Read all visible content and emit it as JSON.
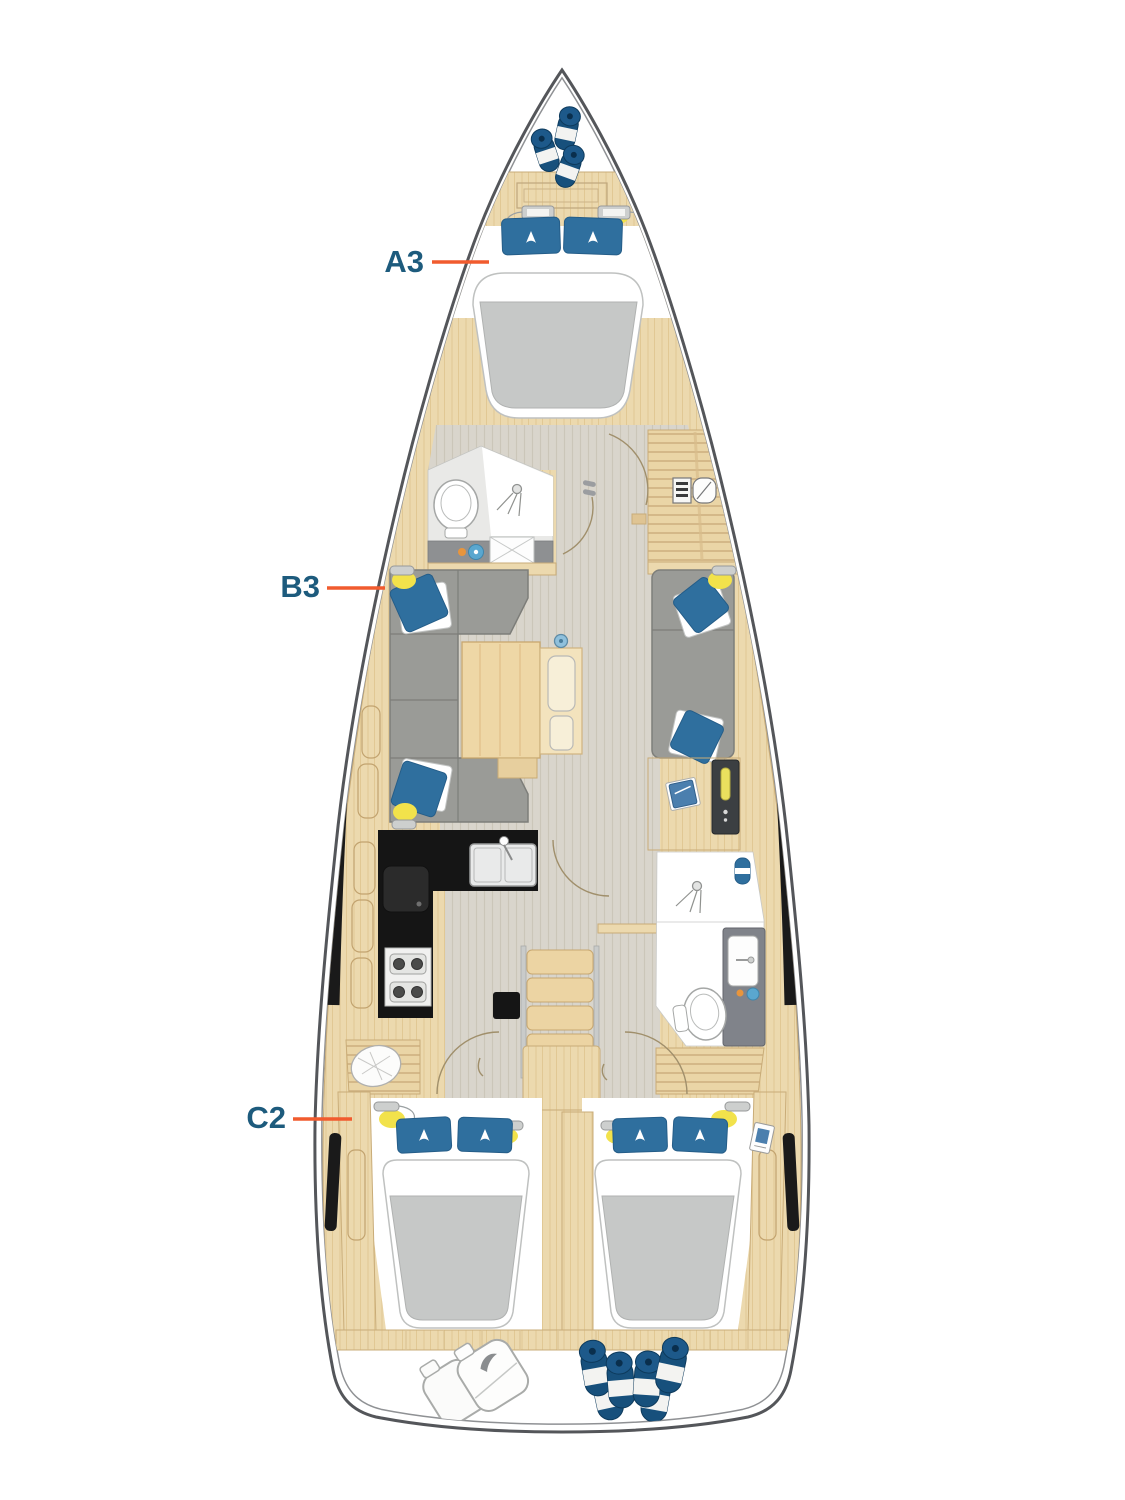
{
  "diagram": {
    "type": "yacht-deck-plan",
    "labels": [
      {
        "id": "a3",
        "text": "A3"
      },
      {
        "id": "b3",
        "text": "B3"
      },
      {
        "id": "c2",
        "text": "C2"
      }
    ],
    "colors": {
      "label_text": "#1d5b7d",
      "leader_line": "#f15b2e",
      "hull_outline": "#54565a",
      "hull_inner_line": "#8f9194",
      "wood": "#ecd9ae",
      "floor": "#d9d5cc",
      "galley_counter": "#151515",
      "upholstery_gray": "#9a9b97",
      "mattress_gray": "#c6c8c7",
      "pillow_blue": "#2f6f9e",
      "accent_yellow": "#f2e24b",
      "fender_navy": "#1b5580",
      "window_black": "#1a1a1a"
    }
  }
}
